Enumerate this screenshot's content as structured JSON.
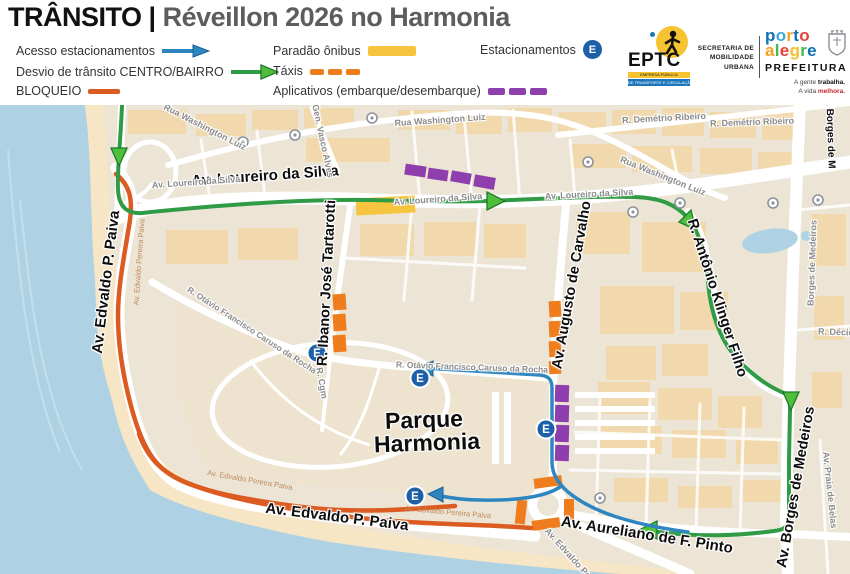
{
  "header": {
    "title_left": "TRÂNSITO",
    "title_sep": "|",
    "title_right": "Réveillon 2026 no Harmonia",
    "legend": {
      "acesso": "Acesso estacionamentos",
      "desvio": "Desvio de trânsito CENTRO/BAIRRO",
      "bloqueio": "BLOQUEIO",
      "paradao": "Paradão ônibus",
      "taxis": "Táxis",
      "aplicativos": "Aplicativos (embarque/desembarque)",
      "estacionamentos": "Estacionamentos",
      "badge_letter": "E"
    },
    "logos": {
      "eptc": "EPTC",
      "eptc_sub1": "EMPRESA PÚBLICA",
      "eptc_sub2": "DE TRANSPORTE E CIRCULAÇÃO",
      "secretaria_line1": "SECRETARIA DE",
      "secretaria_line2": "MOBILIDADE URBANA",
      "porto": "porto",
      "alegre": "alegre",
      "porto_colors": [
        "#0e72b5",
        "#3fa9dc",
        "#f5a11c",
        "#0e72b5",
        "#e8423c"
      ],
      "alegre_colors": [
        "#f5a11c",
        "#45b854",
        "#e8423c",
        "#f2c233",
        "#45b854",
        "#0e72b5"
      ],
      "prefeitura": "PREFEITURA",
      "tagline_1a": "A gente ",
      "tagline_1b": "trabalha.",
      "tagline_2a": "A vida ",
      "tagline_2b": "melhora."
    }
  },
  "colors": {
    "route_green": "#2f9b45",
    "route_blue": "#2e86c1",
    "bloqueio": "#dc5b21",
    "taxi": "#ef7d1d",
    "bus_yellow": "#f6c43e",
    "app_purple": "#8f3fad",
    "badge_blue": "#1d5fa8",
    "water": "#aed2e3"
  },
  "map": {
    "badge_letter": "E",
    "labels": [
      "Av. Loureiro da Silva",
      "Av. Edvaldo P. Paiva",
      "R. Ibanor José Tartarotti",
      "Av. Augusto de Carvalho",
      "R. Antônio Klinger Filho",
      "Av. Borges de Medeiros",
      "Av. Borges de M",
      "Parque",
      "Harmonia",
      "Av. Edvaldo P. Paiva",
      "Av. Aureliano de F. Pinto",
      "Rua Washington Luiz",
      "Rua Washington Luiz",
      "Rua Washington Luiz",
      "R. Demétrio Ribeiro",
      "R. Demétrio Ribeiro",
      "Gen. Vasco Alves",
      "Av. Loureiro da Silva",
      "Av. Loureiro da Silva",
      "Av. Loureiro da Silva",
      "R. Otávio Francisco Caruso da Rocha",
      "R. Otávio Francisco Caruso da Rocha",
      "R. Cgm",
      "Borges de Medeiros",
      "R. Décio",
      "Av. Praia de Belas",
      "Av. Edvaldo Pe",
      "Av. Edvaldo Pereira Paiva",
      "Av. Edvaldo Pereira Paiva",
      "Av. Edvaldo Pereira Paiva"
    ]
  }
}
